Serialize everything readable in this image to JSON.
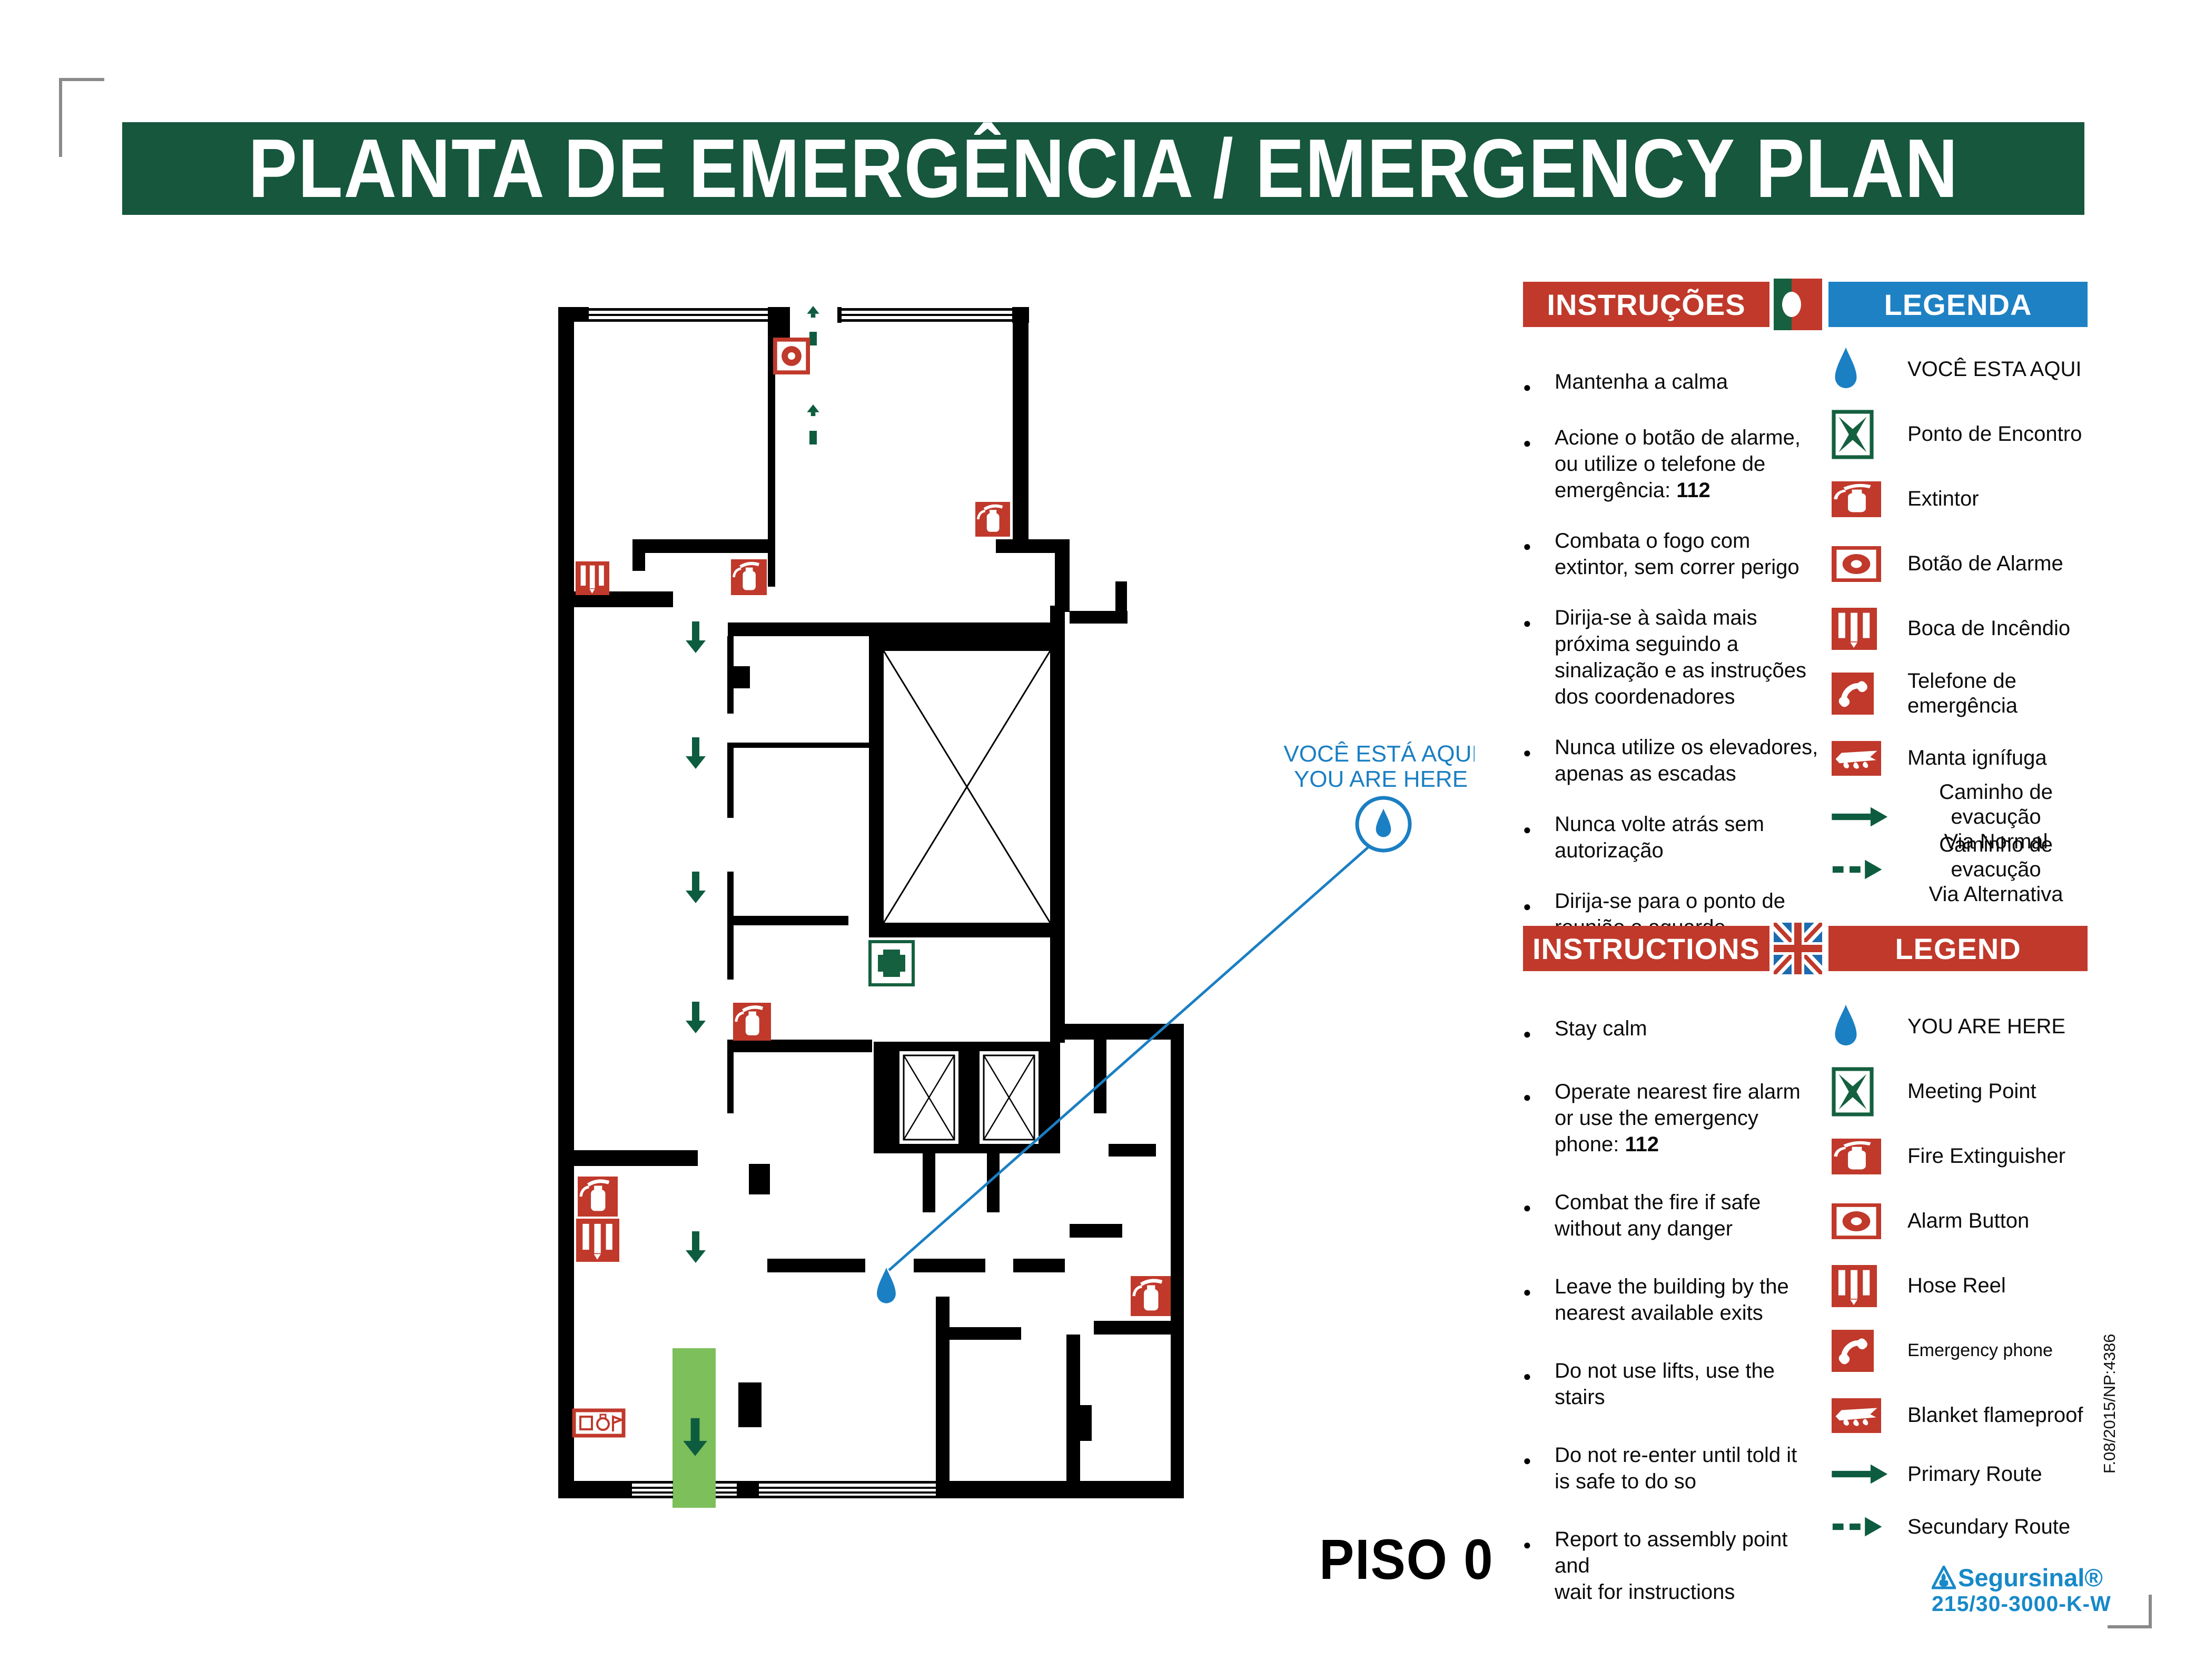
{
  "title": "PLANTA DE EMERGÊNCIA / EMERGENCY PLAN",
  "floor_label": "PISO 0",
  "you_are_here_callout": {
    "line1": "VOCÊ ESTÁ AQUI",
    "line2": "YOU ARE HERE"
  },
  "sections": {
    "pt": {
      "instructions_title": "INSTRUÇÕES",
      "legend_title": "LEGENDA",
      "flag": "portugal-flag",
      "instructions": [
        {
          "lines": [
            "Mantenha a calma"
          ]
        },
        {
          "lines": [
            "Acione o botão de alarme,",
            "ou utilize o telefone de",
            "emergência: "
          ],
          "bold_tail": "112"
        },
        {
          "lines": [
            "Combata o fogo com",
            "extintor, sem correr perigo"
          ]
        },
        {
          "lines": [
            "Dirija-se à saìda mais",
            "próxima seguindo a",
            "sinalização e as instruções",
            "dos coordenadores"
          ]
        },
        {
          "lines": [
            "Nunca utilize os elevadores,",
            "apenas as escadas"
          ]
        },
        {
          "lines": [
            "Nunca volte atrás sem",
            "autorização"
          ]
        },
        {
          "lines": [
            "Dirija-se para o ponto de",
            "reunião e aguarde instruções"
          ]
        }
      ],
      "legend": [
        {
          "icon": "you-are-here-drop",
          "label": "VOCÊ ESTA AQUI"
        },
        {
          "icon": "meeting-point",
          "label": "Ponto de Encontro"
        },
        {
          "icon": "fire-extinguisher",
          "label": "Extintor"
        },
        {
          "icon": "alarm-button",
          "label": "Botão de Alarme"
        },
        {
          "icon": "hose-reel",
          "label": "Boca de Incêndio"
        },
        {
          "icon": "emergency-phone",
          "label": "Telefone de emergência"
        },
        {
          "icon": "fire-blanket",
          "label": "Manta ignífuga"
        },
        {
          "icon": "route-solid-arrow",
          "label": "Caminho de evacução",
          "label2": "Via Normal"
        },
        {
          "icon": "route-dashed-arrow",
          "label": "Caminho de evacução",
          "label2": "Via Alternativa"
        }
      ]
    },
    "en": {
      "instructions_title": "INSTRUCTIONS",
      "legend_title": "LEGEND",
      "flag": "uk-flag",
      "instructions": [
        {
          "lines": [
            "Stay calm"
          ]
        },
        {
          "lines": [
            "Operate nearest fire alarm",
            "or use the emergency",
            "phone: "
          ],
          "bold_tail": "112"
        },
        {
          "lines": [
            "Combat the fire if safe",
            "without any danger"
          ]
        },
        {
          "lines": [
            "Leave the building by the",
            "nearest available exits"
          ]
        },
        {
          "lines": [
            "Do not use lifts, use the",
            "stairs"
          ]
        },
        {
          "lines": [
            "Do not re-enter until told it",
            "is safe to do so"
          ]
        },
        {
          "lines": [
            "Report to assembly point and",
            "wait for instructions"
          ]
        }
      ],
      "legend": [
        {
          "icon": "you-are-here-drop",
          "label": "YOU ARE HERE"
        },
        {
          "icon": "meeting-point",
          "label": "Meeting Point"
        },
        {
          "icon": "fire-extinguisher",
          "label": "Fire Extinguisher"
        },
        {
          "icon": "alarm-button",
          "label": "Alarm Button"
        },
        {
          "icon": "hose-reel",
          "label": "Hose Reel"
        },
        {
          "icon": "emergency-phone",
          "label": "Emergency phone",
          "small": true
        },
        {
          "icon": "fire-blanket",
          "label": "Blanket flameproof"
        },
        {
          "icon": "route-solid-arrow",
          "label": "Primary Route"
        },
        {
          "icon": "route-dashed-arrow",
          "label": "Secundary Route"
        }
      ]
    }
  },
  "footer": {
    "brand": "Segursinal®",
    "code": "215/30-3000-K-W",
    "side_code": "F.08/2015/NP:4386"
  },
  "colors": {
    "title_green": "#16573E",
    "header_red": "#C0392B",
    "header_blue": "#1E81C4",
    "icon_red": "#C0392B",
    "arrow_green": "#0E5C3F",
    "meeting_green": "#14603F",
    "exit_green": "#7CBF5B",
    "blue": "#1B7FC3",
    "brand_blue": "#1789C8"
  }
}
